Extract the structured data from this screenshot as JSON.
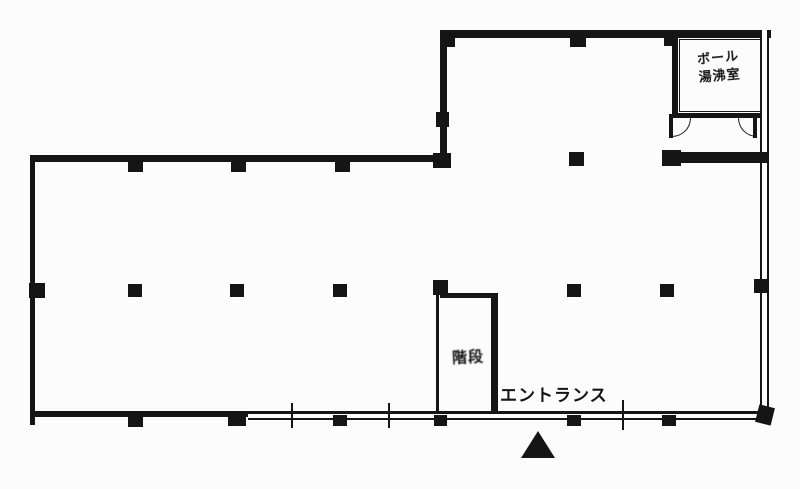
{
  "document": {
    "kind": "floor-plan",
    "paper_color": "#fcfcfc",
    "ink_color": "#151515",
    "labels": {
      "entrance": "エントランス",
      "stairs": "階段",
      "utility_room_line1": "ボール",
      "utility_room_line2": "湯沸室"
    },
    "icons": {
      "entrance_marker": "filled-triangle-up"
    }
  }
}
